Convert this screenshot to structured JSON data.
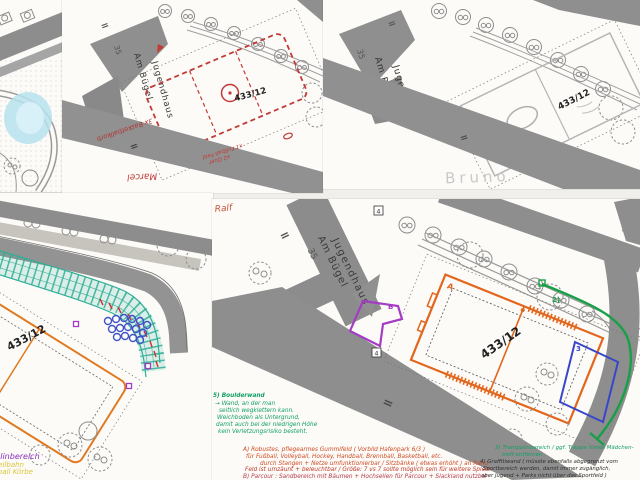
{
  "page": {
    "background": "#f0efeb",
    "paper": "#fcfbf8"
  },
  "colors": {
    "red_annotation": "#c23a35",
    "orange_annotation": "#e2661c",
    "green_annotation": "#13a35f",
    "green_plan": "#17a047",
    "teal_grid": "#2fae97",
    "blue_plan": "#3747c8",
    "purple_plan": "#a33bc4",
    "yellow_annotation": "#dfc93d",
    "pencil_gray": "#c9c9c9",
    "street_gray": "#8e8e8e",
    "black_ink": "#2b2b2b"
  },
  "plan_common": {
    "building_name_line1": "Jugendhaus",
    "building_name_line2": "Am Bügel",
    "building_number": "35",
    "parcel_number": "433/12",
    "equals_mark": "="
  },
  "panel_top_middle": {
    "author": "Marcel",
    "note_basketball": "3x Basketballkorb",
    "note_field_line1": "x1 Fußball Feld",
    "note_field_line2": "x2 Quer"
  },
  "panel_top_right": {
    "author": "Bruno"
  },
  "panel_bottom_left": {
    "legend_purple": "Trampolinbereich",
    "legend_yellow_line1": "mit Seilbahn",
    "legend_yellow_line2": "Basketball Körbe"
  },
  "panel_bottom_right": {
    "author": "Ralf",
    "label_field_a": "A",
    "label_parcour_b": "B",
    "label_green_2": "2)",
    "label_blue_3": "3",
    "label_box4_top": "4",
    "label_box4_bottom": "4",
    "notes_boulderwand": [
      "5) Boulderwand",
      "→ Wand, an der man",
      "seitlich wegklettern kann.",
      "Weichboden als Untergrund,",
      "damit auch bei der niedrigen Höhe",
      "kein Verletzungsrisiko besteht."
    ],
    "notes_gummifeld": [
      "A) Robustes, pflegearmes Gummifeld ( Vorbild Hafenpark 6/3 )",
      "für Fußball, Volleyball, Hockey, Handball, Brennball, Basketball, etc.",
      "durch Stangen + Netze umfunktionierbar / Sitzbänke ( etwas erhöht ) an Rand",
      "Feld ist umzäunt + beleuchtbar / Größe: 7 vs 7 sollte möglich sein für weitere Spiele"
    ],
    "note_parcour": "B) Parcour : Sandbereich mit Bäumen + Hochseilen für Parcour + Slackland nutzbar",
    "notes_trampolin": [
      "3) Trampolinbereich / ggf. Treppe hinter Mädchen-",
      "treff entfernen"
    ],
    "notes_graffitiwand": [
      "4) Graffitiwand ( müsste ebenfalls abgegrenzt vom",
      "Sportbereich werden, damit immer zugänglich,",
      "aber Jugend + Parks nicht über das Sportfeld )"
    ]
  }
}
